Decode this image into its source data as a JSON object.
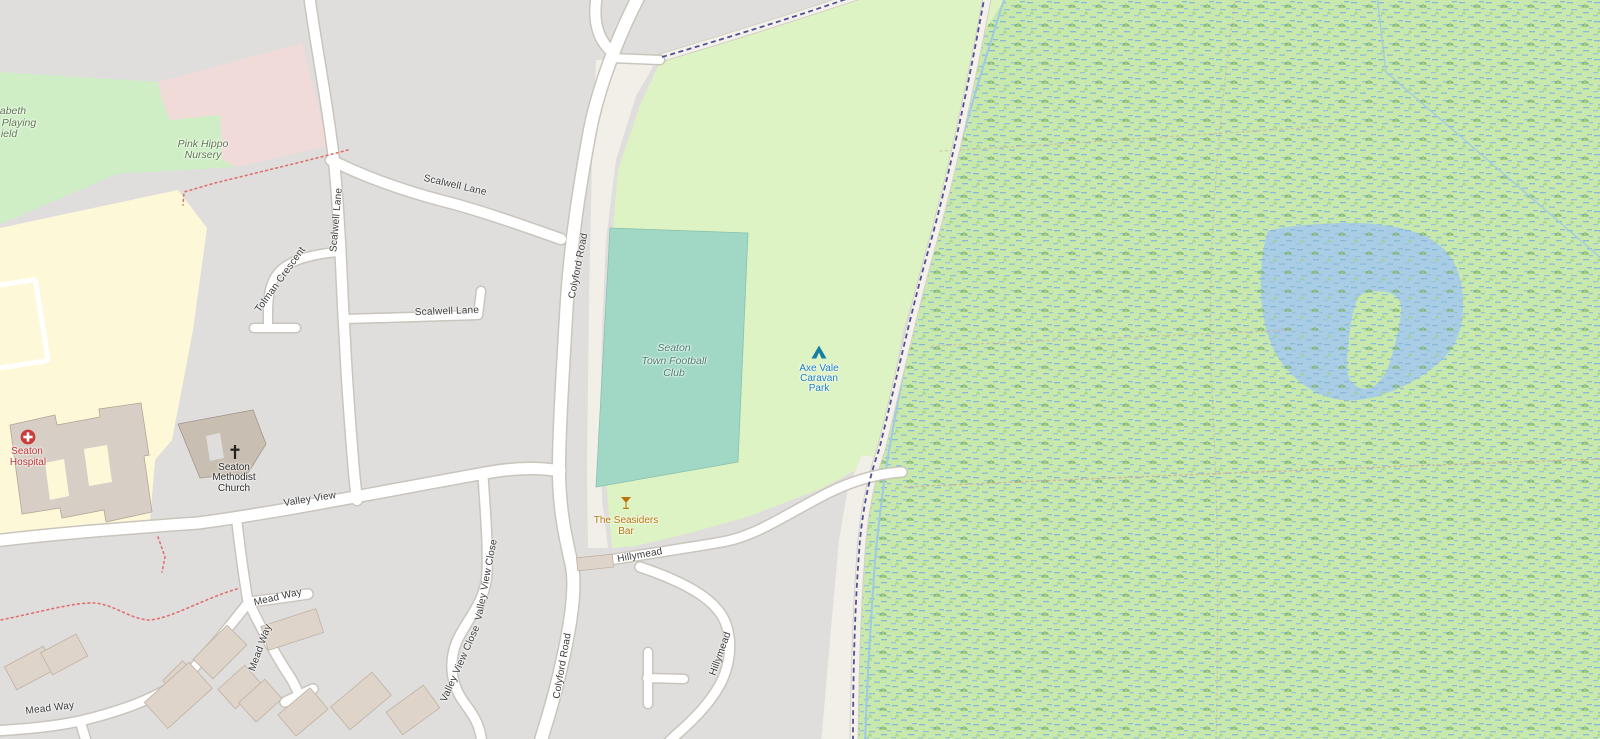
{
  "labels": {
    "playing_field": [
      "abeth",
      "Playing",
      "ield"
    ],
    "nursery": [
      "Pink Hippo",
      "Nursery"
    ],
    "roads": {
      "scalwell_lane": "Scalwell Lane",
      "tolman_crescent": "Tolman Crescent",
      "colyford_road": "Colyford Road",
      "valley_view": "Valley View",
      "valley_view_close": "Valley View Close",
      "mead_way": "Mead Way",
      "hillymead": "Hillymead"
    },
    "pois": {
      "football_club": [
        "Seaton",
        "Town Football",
        "Club"
      ],
      "caravan_park": [
        "Axe Vale",
        "Caravan",
        "Park"
      ],
      "hospital": [
        "Seaton",
        "Hospital"
      ],
      "church": [
        "Seaton",
        "Methodist",
        "Church"
      ],
      "bar": [
        "The Seasiders",
        "Bar"
      ]
    }
  },
  "icons": {
    "campsite": "campsite-icon",
    "hospital": "hospital-cross-icon",
    "church": "church-cross-icon",
    "bar": "bar-glass-icon"
  },
  "colors": {
    "residential": "#dfdedd",
    "land": "#f2efe9",
    "grass_field": "#cfeec6",
    "hospital_grounds": "#fdf9d8",
    "retail_pink": "#f0dbd9",
    "campsite_green": "#def3c3",
    "pitch_teal": "#a1d8c5",
    "wetland_base": "#c8e8ac",
    "water": "#a9cde4",
    "road_fill": "#ffffff",
    "road_casing": "#c9c5bc",
    "path_fill": "#f4f1ea",
    "path_casing": "#d4d0c6",
    "boundary": "#3f3f8f",
    "stream": "#9fc9e4",
    "footpath_dots": "#e07070",
    "track_dots": "#cdaa9b",
    "building": "#ded4c9",
    "building_dark": "#c9beb2",
    "label_road": "#3b3b3b",
    "label_area_green": "#5d7a4d",
    "label_pitch": "#4e7d72",
    "label_tourism": "#1a7fc1",
    "label_hospital": "#bf3434",
    "label_bar": "#b8740a",
    "icon_campsite": "#157ea2",
    "icon_hospital": "#c93c3c",
    "icon_bar": "#b8740a"
  }
}
